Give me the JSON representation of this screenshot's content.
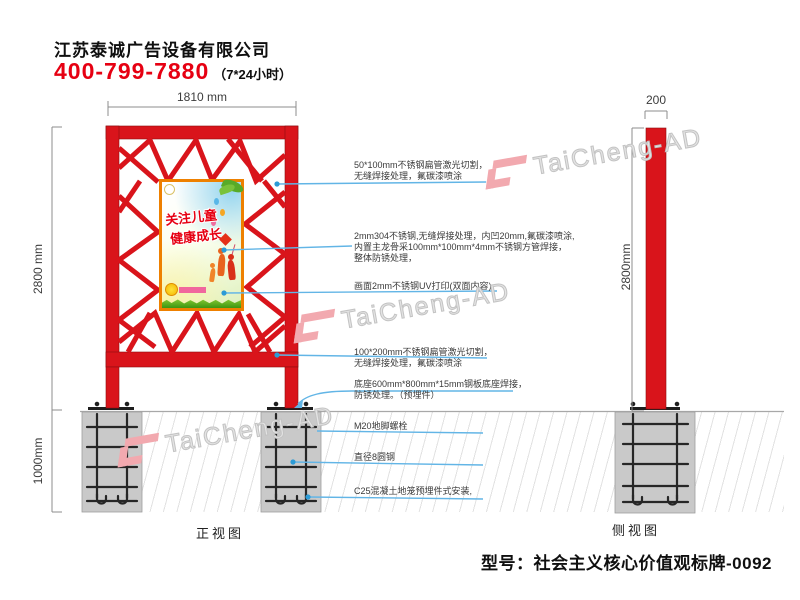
{
  "header": {
    "company": "江苏泰诚广告设备有限公司",
    "phone": "400-799-7880",
    "hours": "（7*24小时）"
  },
  "dims": {
    "front_width": "1810 mm",
    "front_height": "2800 mm",
    "foundation_depth": "1000mm",
    "side_width": "200",
    "side_height": "2800mm"
  },
  "views": {
    "front": "正视图",
    "side": "侧视图"
  },
  "annotations": {
    "a1": {
      "lines": [
        "50*100mm不锈钢扁管激光切割，",
        "无缝焊接处理，氟碳漆喷涂"
      ]
    },
    "a2": {
      "lines": [
        "2mm304不锈钢,无缝焊接处理，内凹20mm,氟碳漆喷涂,",
        "内置主龙骨采100mm*100mm*4mm不锈钢方管焊接，",
        "整体防锈处理，"
      ]
    },
    "a3": {
      "lines": [
        "画面2mm不锈钢UV打印(双面内容)"
      ]
    },
    "a4": {
      "lines": [
        "100*200mm不锈钢扁管激光切割，",
        "无缝焊接处理，氟碳漆喷涂"
      ]
    },
    "a5": {
      "lines": [
        "底座600mm*800mm*15mm钢板底座焊接，",
        "防锈处理。（预埋件）"
      ]
    },
    "a6": {
      "lines": [
        "M20地脚螺栓"
      ]
    },
    "a7": {
      "lines": [
        "直径8圆钢"
      ]
    },
    "a8": {
      "lines": [
        "C25混凝土地笼预埋件式安装,"
      ]
    }
  },
  "poster": {
    "line1": "关注儿童",
    "line2": "健康成长"
  },
  "watermark": {
    "text": "TaiCheng-AD"
  },
  "model": {
    "text": "型号：社会主义核心价值观标牌-0092"
  },
  "colors": {
    "structure_red": "#d9141b",
    "phone_red": "#e60012",
    "poster_border": "#ee8000",
    "callout_blue": "#62b5e6",
    "foundation_gray": "#c9c9c9",
    "watermark_pink": "#f2a9af"
  }
}
